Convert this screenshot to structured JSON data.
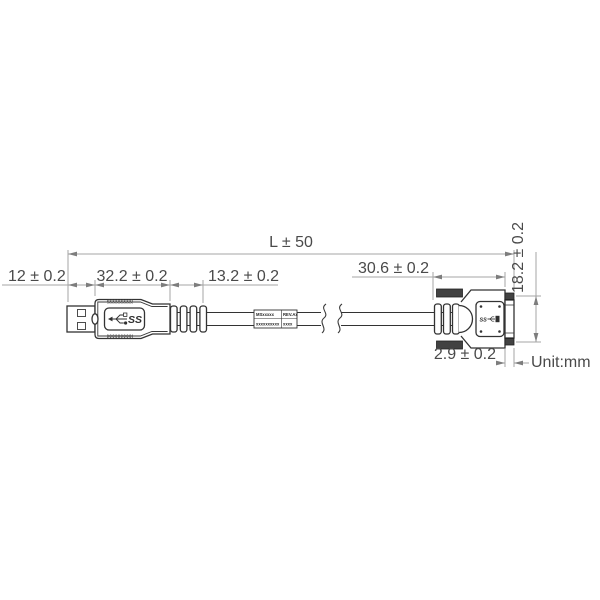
{
  "diagram": {
    "unit_label": "Unit:mm",
    "dimensions": {
      "overall_length": "L ± 50",
      "usb_a_shell_length": "12 ± 0.2",
      "usb_a_body_length": "32.2 ± 0.2",
      "usb_a_boot_length": "13.2 ± 0.2",
      "micro_b_body_length": "30.6 ± 0.2",
      "micro_b_height": "18.2 ± 0.2",
      "screw_tip_length": "2.9 ± 0.2"
    },
    "connector_markings": {
      "usb_a_logo_text": "SS",
      "micro_b_logo_text": "SS"
    },
    "cable_label": {
      "row1_left": "MSxxxxx",
      "row1_right": "REV.Ax",
      "row2_left": "xxxxxxxxxx",
      "row2_right": "xxxx"
    },
    "colors": {
      "outline": "#333333",
      "dimension_lines": "#a6a6a6",
      "text": "#4a4a4a",
      "screw_fill": "#424242",
      "background": "#ffffff"
    }
  }
}
